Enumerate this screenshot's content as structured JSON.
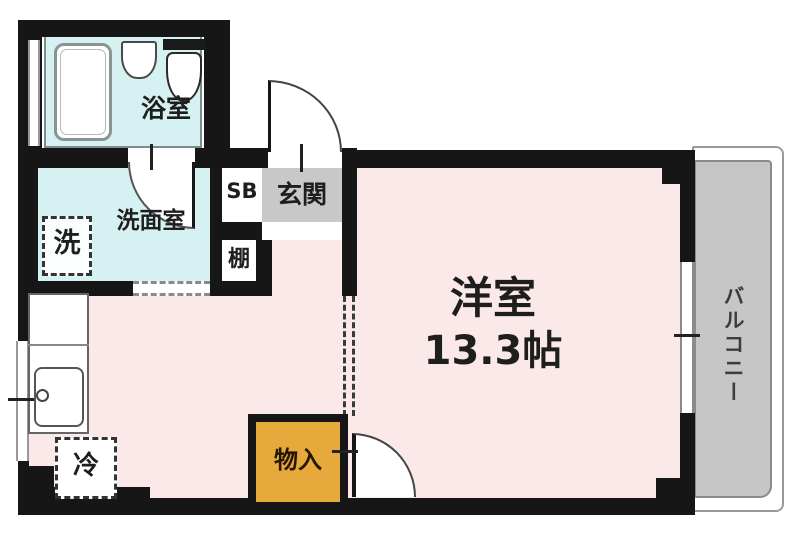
{
  "floorplan": {
    "labels": {
      "bathroom": "浴室",
      "washroom": "洗面室",
      "washing_machine": "洗",
      "shoe_box": "SB",
      "entrance": "玄関",
      "shelf": "棚",
      "refrigerator": "冷",
      "storage": "物入",
      "main_room_name": "洋室",
      "main_room_size": "13.3帖",
      "balcony": "バルコニー"
    },
    "colors": {
      "wall": "#161616",
      "main_room_floor": "#fae9e8",
      "wet_area_floor": "#d6f1f2",
      "entrance_floor": "#c8c8c8",
      "balcony_floor": "#c6c6c6",
      "storage_fill": "#e7a93c"
    }
  }
}
